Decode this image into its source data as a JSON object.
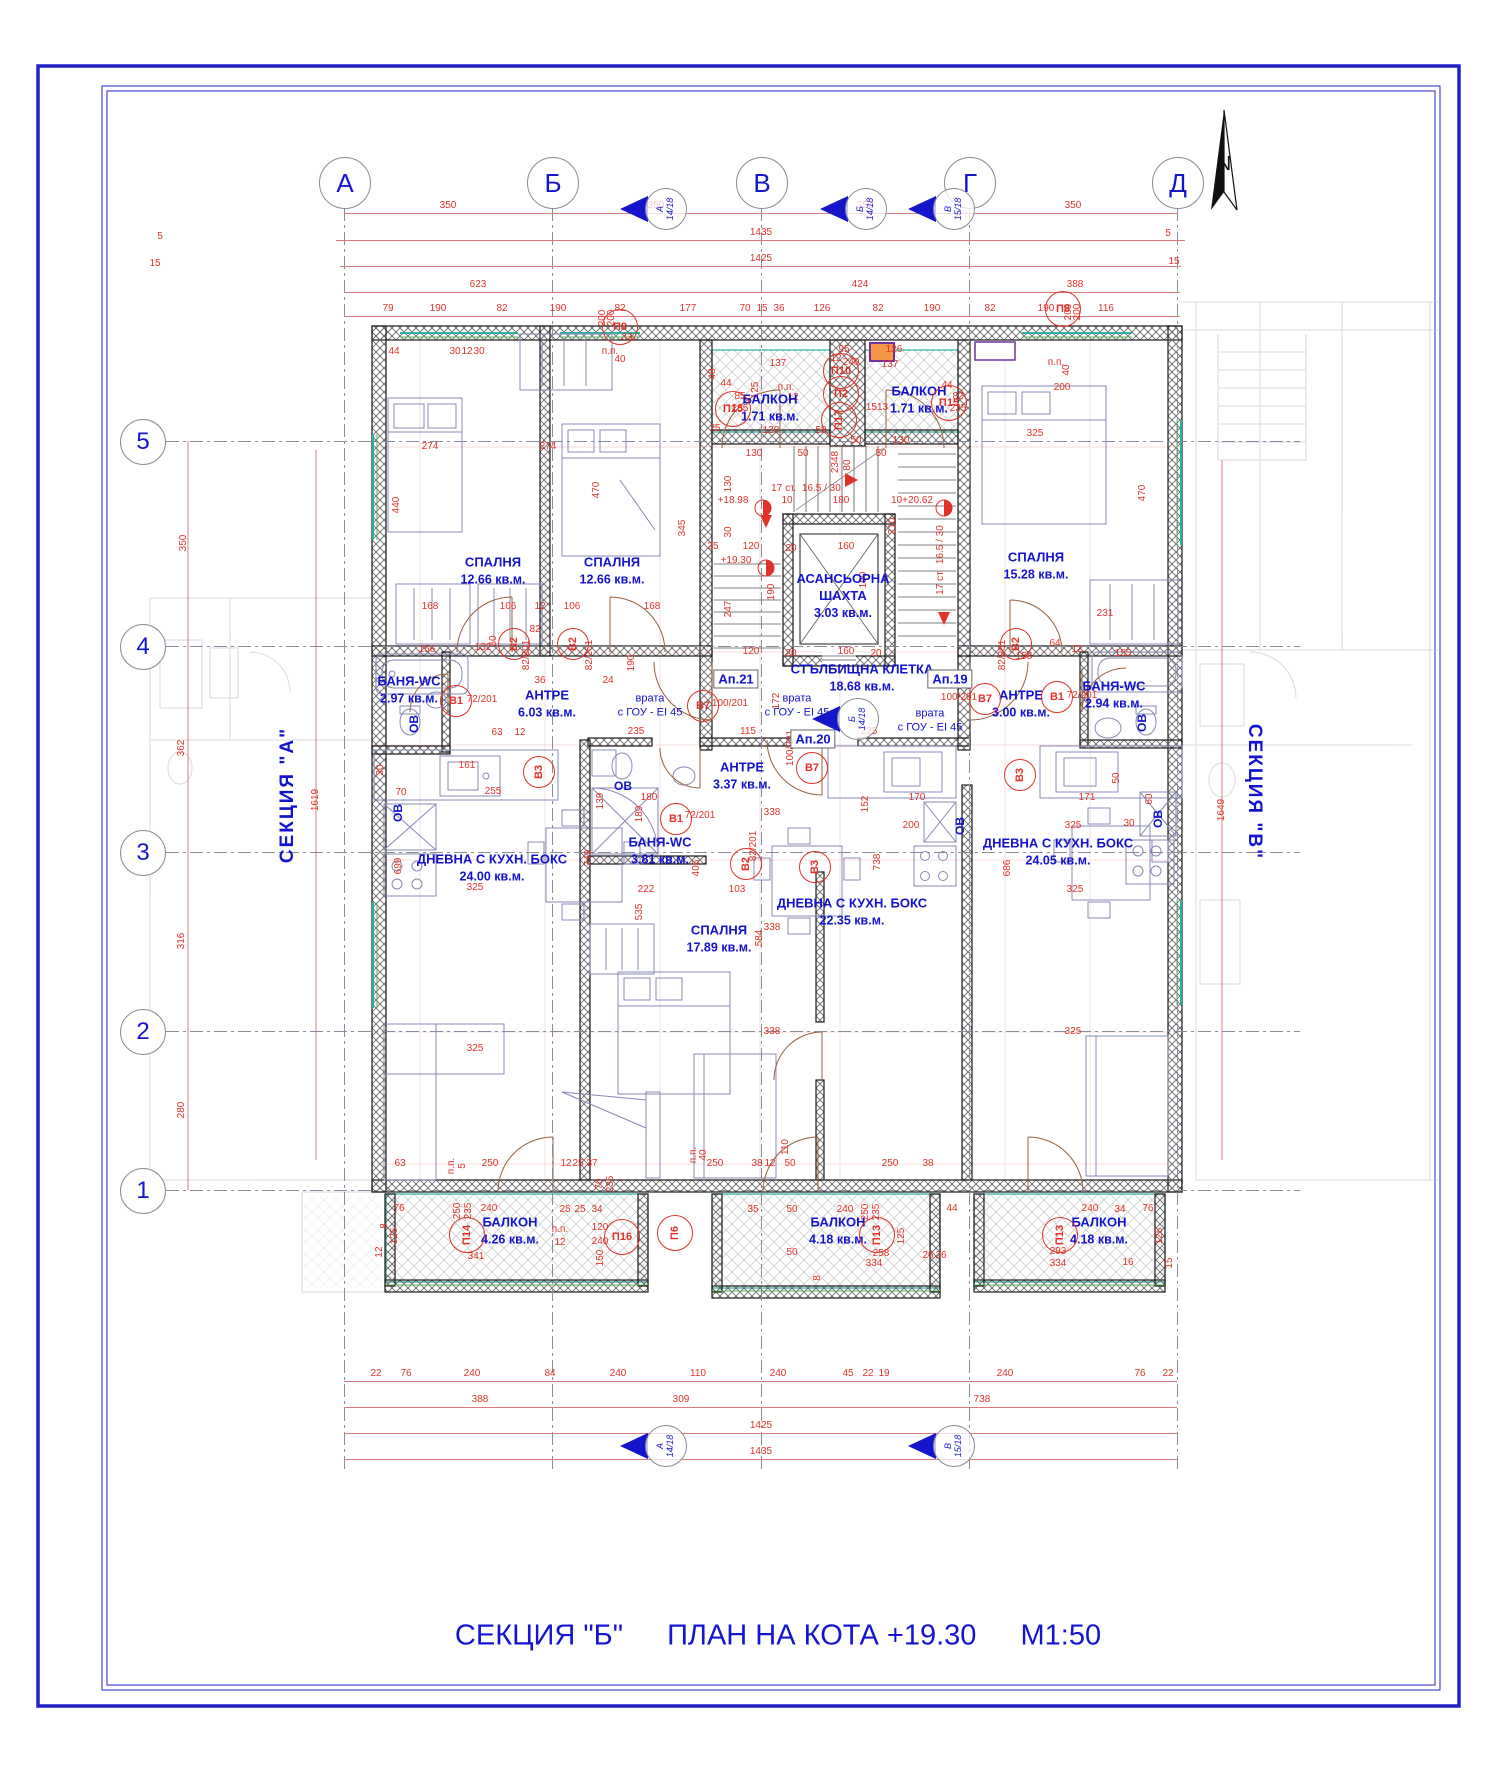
{
  "title": {
    "section": "СЕКЦИЯ \"Б\"",
    "plan": "ПЛАН НА КОТА +19.30",
    "scale": "М1:50"
  },
  "north": {
    "label": "N"
  },
  "side_sections": {
    "left": "СЕКЦИЯ  \"А\"",
    "right": "СЕКЦИЯ  \"В\""
  },
  "grid": {
    "cols": [
      {
        "label": "А",
        "x": 344
      },
      {
        "label": "Б",
        "x": 552
      },
      {
        "label": "В",
        "x": 761
      },
      {
        "label": "Г",
        "x": 969
      },
      {
        "label": "Д",
        "x": 1177
      }
    ],
    "rows": [
      {
        "label": "5",
        "y": 441
      },
      {
        "label": "4",
        "y": 646
      },
      {
        "label": "3",
        "y": 852
      },
      {
        "label": "2",
        "y": 1031
      },
      {
        "label": "1",
        "y": 1190
      }
    ]
  },
  "section_flags": [
    {
      "letter": "А",
      "ratio": "14/18",
      "x": 648,
      "y": 208
    },
    {
      "letter": "Б",
      "ratio": "14/18",
      "x": 848,
      "y": 208
    },
    {
      "letter": "В",
      "ratio": "15/18",
      "x": 936,
      "y": 208
    },
    {
      "letter": "Б",
      "ratio": "14/18",
      "x": 840,
      "y": 718
    },
    {
      "letter": "А",
      "ratio": "14/18",
      "x": 648,
      "y": 1445
    },
    {
      "letter": "В",
      "ratio": "15/18",
      "x": 936,
      "y": 1445
    }
  ],
  "rooms": [
    {
      "name": "СПАЛНЯ",
      "area": "12.66 кв.м.",
      "x": 493,
      "y": 571
    },
    {
      "name": "СПАЛНЯ",
      "area": "12.66 кв.м.",
      "x": 612,
      "y": 571
    },
    {
      "name": "СПАЛНЯ",
      "area": "15.28 кв.м.",
      "x": 1036,
      "y": 566
    },
    {
      "name": "СПАЛНЯ",
      "area": "17.89 кв.м.",
      "x": 719,
      "y": 939
    },
    {
      "name": "БАНЯ-WC",
      "area": "2.97 кв.м.",
      "x": 409,
      "y": 690
    },
    {
      "name": "БАНЯ-WC",
      "area": "2.94 кв.м.",
      "x": 1114,
      "y": 695
    },
    {
      "name": "БАНЯ-WC",
      "area": "3.81 кв.м.",
      "x": 660,
      "y": 851
    },
    {
      "name": "АНТРЕ",
      "area": "6.03 кв.м.",
      "x": 547,
      "y": 704
    },
    {
      "name": "АНТРЕ",
      "area": "3.00 кв.м.",
      "x": 1021,
      "y": 704
    },
    {
      "name": "АНТРЕ",
      "area": "3.37 кв.м.",
      "x": 742,
      "y": 776
    },
    {
      "name": "ДНЕВНА С КУХН. БОКС",
      "area": "24.00 кв.м.",
      "x": 492,
      "y": 868
    },
    {
      "name": "ДНЕВНА С КУХН. БОКС",
      "area": "22.35 кв.м.",
      "x": 852,
      "y": 912
    },
    {
      "name": "ДНЕВНА С КУХН. БОКС",
      "area": "24.05 кв.м.",
      "x": 1058,
      "y": 852
    },
    {
      "name": "БАЛКОН",
      "area": "1.71 кв.м.",
      "x": 770,
      "y": 408
    },
    {
      "name": "БАЛКОН",
      "area": "1.71 кв.м.",
      "x": 919,
      "y": 400
    },
    {
      "name": "БАЛКОН",
      "area": "4.26 кв.м.",
      "x": 510,
      "y": 1231
    },
    {
      "name": "БАЛКОН",
      "area": "4.18 кв.м.",
      "x": 838,
      "y": 1231
    },
    {
      "name": "БАЛКОН",
      "area": "4.18 кв.м.",
      "x": 1099,
      "y": 1231
    },
    {
      "name": "АСАНСЬОРНА ШАХТА",
      "area": "3.03 кв.м.",
      "x": 843,
      "y": 596,
      "w": 120
    },
    {
      "name": "СТЪЛБИЩНА КЛЕТКА",
      "area": "18.68 кв.м.",
      "x": 862,
      "y": 678
    }
  ],
  "apartments": [
    {
      "label": "Ап.21",
      "x": 736,
      "y": 679
    },
    {
      "label": "Ап.20",
      "x": 813,
      "y": 739
    },
    {
      "label": "Ап.19",
      "x": 950,
      "y": 679
    }
  ],
  "door_note": {
    "line1": "врата",
    "line2": "с ГОУ - EI 45",
    "positions": [
      {
        "x": 650,
        "y": 706
      },
      {
        "x": 797,
        "y": 706
      },
      {
        "x": 930,
        "y": 721
      }
    ]
  },
  "ov_label": {
    "text": "ОВ",
    "positions": [
      {
        "x": 414,
        "y": 724,
        "r": 1
      },
      {
        "x": 398,
        "y": 813,
        "r": 1
      },
      {
        "x": 623,
        "y": 786
      },
      {
        "x": 960,
        "y": 826,
        "r": 1
      },
      {
        "x": 1142,
        "y": 723,
        "r": 1
      },
      {
        "x": 1158,
        "y": 819,
        "r": 1
      }
    ]
  },
  "valve_circles": [
    {
      "t": "В1",
      "x": 456,
      "y": 701
    },
    {
      "t": "В2",
      "x": 514,
      "y": 644,
      "r": 1
    },
    {
      "t": "В2",
      "x": 573,
      "y": 644,
      "r": 1
    },
    {
      "t": "В3",
      "x": 539,
      "y": 772,
      "r": 1
    },
    {
      "t": "В7",
      "x": 703,
      "y": 706
    },
    {
      "t": "В7",
      "x": 812,
      "y": 768
    },
    {
      "t": "В1",
      "x": 676,
      "y": 819
    },
    {
      "t": "В2",
      "x": 746,
      "y": 864,
      "r": 1
    },
    {
      "t": "В3",
      "x": 815,
      "y": 867,
      "r": 1
    },
    {
      "t": "В7",
      "x": 985,
      "y": 699
    },
    {
      "t": "В1",
      "x": 1057,
      "y": 697
    },
    {
      "t": "В2",
      "x": 1016,
      "y": 644,
      "r": 1
    },
    {
      "t": "В3",
      "x": 1020,
      "y": 775,
      "r": 1
    }
  ],
  "panel_circles": [
    {
      "t": "П8",
      "x": 620,
      "y": 327
    },
    {
      "t": "П8",
      "x": 1063,
      "y": 309
    },
    {
      "t": "П10",
      "x": 841,
      "y": 371
    },
    {
      "t": "П2",
      "x": 841,
      "y": 394
    },
    {
      "t": "П17",
      "x": 839,
      "y": 420,
      "r": 1
    },
    {
      "t": "П15",
      "x": 733,
      "y": 409
    },
    {
      "t": "П15",
      "x": 949,
      "y": 403
    },
    {
      "t": "П14",
      "x": 467,
      "y": 1235,
      "r": 1
    },
    {
      "t": "П16",
      "x": 622,
      "y": 1237
    },
    {
      "t": "П6",
      "x": 675,
      "y": 1233,
      "r": 1
    },
    {
      "t": "П13",
      "x": 877,
      "y": 1235,
      "r": 1
    },
    {
      "t": "П13",
      "x": 1060,
      "y": 1235,
      "r": 1
    }
  ],
  "dim_rows": {
    "top": [
      {
        "y": 213,
        "x1": 344,
        "x2": 1177,
        "labels": [
          [
            "350",
            448
          ],
          [
            "350",
            656
          ],
          [
            "350",
            865
          ],
          [
            "350",
            1073
          ]
        ]
      },
      {
        "y": 240,
        "x1": 336,
        "x2": 1185,
        "labels": [
          [
            "1435",
            761
          ]
        ]
      },
      {
        "y": 266,
        "x1": 340,
        "x2": 1181,
        "labels": [
          [
            "1425",
            761
          ]
        ]
      },
      {
        "y": 292,
        "x1": 344,
        "x2": 1180,
        "labels": [
          [
            "623",
            478
          ],
          [
            "424",
            860
          ],
          [
            "388",
            1075
          ]
        ]
      },
      {
        "y": 316,
        "x1": 344,
        "x2": 1180,
        "labels": [
          [
            "79",
            388
          ],
          [
            "190",
            438
          ],
          [
            "82",
            502
          ],
          [
            "190",
            558
          ],
          [
            "82",
            620
          ],
          [
            "177",
            688
          ],
          [
            "70",
            745
          ],
          [
            "15",
            762
          ],
          [
            "36",
            779
          ],
          [
            "126",
            822
          ],
          [
            "82",
            878
          ],
          [
            "190",
            932
          ],
          [
            "82",
            990
          ],
          [
            "190",
            1046
          ],
          [
            "116",
            1106
          ]
        ]
      }
    ],
    "bottom": [
      {
        "y": 1381,
        "x1": 344,
        "x2": 1177,
        "labels": [
          [
            "22",
            376
          ],
          [
            "76",
            406
          ],
          [
            "240",
            472
          ],
          [
            "84",
            550
          ],
          [
            "240",
            618
          ],
          [
            "110",
            698
          ],
          [
            "240",
            778
          ],
          [
            "45",
            848
          ],
          [
            "22",
            868
          ],
          [
            "19",
            884
          ],
          [
            "240",
            1005
          ],
          [
            "76",
            1140
          ],
          [
            "22",
            1168
          ]
        ]
      },
      {
        "y": 1407,
        "x1": 344,
        "x2": 1177,
        "labels": [
          [
            "388",
            480
          ],
          [
            "309",
            681
          ],
          [
            "738",
            982
          ]
        ]
      },
      {
        "y": 1433,
        "x1": 344,
        "x2": 1177,
        "labels": [
          [
            "1425",
            761
          ]
        ]
      },
      {
        "y": 1459,
        "x1": 344,
        "x2": 1177,
        "labels": [
          [
            "1435",
            761
          ]
        ]
      }
    ]
  },
  "dims": [
    [
      "274",
      430,
      447
    ],
    [
      "274",
      548,
      447
    ],
    [
      "440",
      397,
      505,
      1
    ],
    [
      "470",
      597,
      490,
      1
    ],
    [
      "345",
      683,
      528,
      1
    ],
    [
      "470",
      1143,
      493,
      1
    ],
    [
      "325",
      1035,
      434
    ],
    [
      "44",
      394,
      352
    ],
    [
      "30",
      455,
      352
    ],
    [
      "12",
      467,
      352
    ],
    [
      "30",
      479,
      352
    ],
    [
      "200",
      603,
      318,
      1
    ],
    [
      "200",
      612,
      318,
      1
    ],
    [
      "33",
      627,
      338
    ],
    [
      "п.п.",
      610,
      352
    ],
    [
      "40",
      620,
      360
    ],
    [
      "200",
      1069,
      312,
      1
    ],
    [
      "200",
      1078,
      312,
      1
    ],
    [
      "п.п.",
      1056,
      363
    ],
    [
      "40",
      1067,
      370,
      1
    ],
    [
      "200",
      1062,
      388
    ],
    [
      "137",
      778,
      364
    ],
    [
      "48",
      713,
      374,
      1
    ],
    [
      "85",
      740,
      397
    ],
    [
      "235",
      740,
      409
    ],
    [
      "44",
      726,
      384
    ],
    [
      "125",
      756,
      390,
      1
    ],
    [
      "130",
      771,
      431
    ],
    [
      "50",
      821,
      431
    ],
    [
      "25",
      715,
      429
    ],
    [
      "95",
      844,
      350
    ],
    [
      "12",
      836,
      359
    ],
    [
      "240",
      851,
      363
    ],
    [
      "126",
      894,
      350
    ],
    [
      "137",
      890,
      365
    ],
    [
      "1513",
      877,
      408
    ],
    [
      "44",
      947,
      386
    ],
    [
      "82",
      958,
      397
    ],
    [
      "235",
      958,
      409
    ],
    [
      "50",
      856,
      441
    ],
    [
      "130",
      901,
      441
    ],
    [
      "п.п.",
      786,
      388
    ],
    [
      "12",
      793,
      398
    ],
    [
      "2348",
      836,
      462,
      1
    ],
    [
      "80",
      848,
      465,
      1
    ],
    [
      "130",
      754,
      454
    ],
    [
      "50",
      803,
      454
    ],
    [
      "50",
      881,
      454
    ],
    [
      "17 ст.  16.5 / 30",
      806,
      489
    ],
    [
      "10",
      787,
      501
    ],
    [
      "180",
      841,
      501
    ],
    [
      "+18.98",
      733,
      501
    ],
    [
      "10+20.62",
      912,
      501
    ],
    [
      "130",
      729,
      484,
      1
    ],
    [
      "30",
      729,
      532,
      1
    ],
    [
      "120",
      751,
      547
    ],
    [
      "25",
      713,
      547
    ],
    [
      "20",
      791,
      549
    ],
    [
      "160",
      846,
      547
    ],
    [
      "+19.30",
      736,
      561
    ],
    [
      "190",
      772,
      592,
      1
    ],
    [
      "190",
      864,
      580,
      1
    ],
    [
      "210",
      893,
      526,
      1
    ],
    [
      "247",
      729,
      609,
      1
    ],
    [
      "17 ст.  16.5 / 30",
      941,
      560,
      1
    ],
    [
      "120",
      751,
      652
    ],
    [
      "20",
      791,
      654
    ],
    [
      "160",
      846,
      652
    ],
    [
      "20",
      876,
      654
    ],
    [
      "168",
      430,
      607
    ],
    [
      "106",
      508,
      607
    ],
    [
      "12",
      540,
      607
    ],
    [
      "106",
      572,
      607
    ],
    [
      "168",
      652,
      607
    ],
    [
      "156",
      427,
      650
    ],
    [
      "132",
      483,
      648
    ],
    [
      "36",
      540,
      681
    ],
    [
      "24",
      608,
      681
    ],
    [
      "190",
      632,
      663,
      1
    ],
    [
      "231",
      1105,
      614
    ],
    [
      "64",
      1055,
      644
    ],
    [
      "155",
      1123,
      654
    ],
    [
      "158",
      1024,
      657
    ],
    [
      "12",
      1077,
      650
    ],
    [
      "235",
      636,
      732
    ],
    [
      "115",
      748,
      732
    ],
    [
      "172",
      777,
      701,
      1
    ],
    [
      "225",
      869,
      732
    ],
    [
      "72/201",
      482,
      700
    ],
    [
      "82/201",
      527,
      655,
      1
    ],
    [
      "82/201",
      590,
      655,
      1
    ],
    [
      "100/201",
      730,
      704
    ],
    [
      "100/201",
      959,
      698
    ],
    [
      "72/201",
      1082,
      696
    ],
    [
      "82/201",
      1003,
      655,
      1
    ],
    [
      "100/201",
      791,
      748,
      1
    ],
    [
      "72/201",
      700,
      816
    ],
    [
      "82/201",
      754,
      846,
      1
    ],
    [
      "82",
      535,
      630
    ],
    [
      "60",
      494,
      641,
      1
    ],
    [
      "63",
      497,
      733
    ],
    [
      "12",
      520,
      733
    ],
    [
      "161",
      467,
      766
    ],
    [
      "255",
      493,
      792
    ],
    [
      "70",
      401,
      793
    ],
    [
      "30",
      381,
      770,
      1
    ],
    [
      "325",
      475,
      888
    ],
    [
      "139",
      601,
      801,
      1
    ],
    [
      "180",
      649,
      798
    ],
    [
      "189",
      640,
      814,
      1
    ],
    [
      "222",
      646,
      890
    ],
    [
      "103",
      737,
      890
    ],
    [
      "170",
      917,
      798
    ],
    [
      "171",
      1087,
      798
    ],
    [
      "200",
      911,
      826
    ],
    [
      "325",
      1073,
      826
    ],
    [
      "325",
      1075,
      890
    ],
    [
      "152",
      866,
      804,
      1
    ],
    [
      "50",
      1117,
      778,
      1
    ],
    [
      "60",
      1150,
      799,
      1
    ],
    [
      "30",
      1129,
      824
    ],
    [
      "338",
      772,
      813
    ],
    [
      "338",
      772,
      928
    ],
    [
      "584",
      760,
      938,
      1
    ],
    [
      "406",
      697,
      868,
      1
    ],
    [
      "749",
      589,
      858,
      1
    ],
    [
      "738",
      878,
      862,
      1
    ],
    [
      "686",
      1008,
      868,
      1
    ],
    [
      "699",
      399,
      866,
      1
    ],
    [
      "535",
      640,
      912,
      1
    ],
    [
      "325",
      475,
      1049
    ],
    [
      "338",
      772,
      1032
    ],
    [
      "325",
      1073,
      1032
    ],
    [
      "63",
      400,
      1164
    ],
    [
      "250",
      490,
      1164
    ],
    [
      "п.п.",
      452,
      1166,
      1
    ],
    [
      "5",
      463,
      1166,
      1
    ],
    [
      "37",
      592,
      1164
    ],
    [
      "12",
      566,
      1164
    ],
    [
      "25",
      578,
      1164
    ],
    [
      "70",
      600,
      1184,
      1
    ],
    [
      "235",
      611,
      1184,
      1
    ],
    [
      "250",
      715,
      1164
    ],
    [
      "38",
      757,
      1164
    ],
    [
      "12",
      770,
      1164
    ],
    [
      "50",
      790,
      1164
    ],
    [
      "110",
      786,
      1147,
      1
    ],
    [
      "п.п.",
      694,
      1155,
      1
    ],
    [
      "40",
      704,
      1155,
      1
    ],
    [
      "250",
      890,
      1164
    ],
    [
      "38",
      928,
      1164
    ],
    [
      "76",
      399,
      1209
    ],
    [
      "8",
      385,
      1226,
      1
    ],
    [
      "250",
      458,
      1211,
      1
    ],
    [
      "235",
      469,
      1211,
      1
    ],
    [
      "240",
      489,
      1209
    ],
    [
      "25",
      565,
      1210
    ],
    [
      "25",
      580,
      1210
    ],
    [
      "34",
      597,
      1210
    ],
    [
      "120",
      600,
      1228
    ],
    [
      "240",
      600,
      1242
    ],
    [
      "п.п.",
      560,
      1230
    ],
    [
      "12",
      560,
      1243
    ],
    [
      "341",
      476,
      1257
    ],
    [
      "125",
      395,
      1236,
      1
    ],
    [
      "150",
      601,
      1258,
      1
    ],
    [
      "12",
      380,
      1252,
      1
    ],
    [
      "35",
      753,
      1210
    ],
    [
      "50",
      792,
      1210
    ],
    [
      "240",
      845,
      1210
    ],
    [
      "250",
      866,
      1212,
      1
    ],
    [
      "235",
      877,
      1212,
      1
    ],
    [
      "44",
      952,
      1209
    ],
    [
      "125",
      902,
      1236,
      1
    ],
    [
      "258",
      881,
      1254
    ],
    [
      "334",
      874,
      1264
    ],
    [
      "50",
      792,
      1253
    ],
    [
      "26",
      928,
      1256
    ],
    [
      "26",
      941,
      1256
    ],
    [
      "8",
      818,
      1278,
      1
    ],
    [
      "240",
      1090,
      1209
    ],
    [
      "76",
      1148,
      1209
    ],
    [
      "34",
      1120,
      1210
    ],
    [
      "293",
      1058,
      1252
    ],
    [
      "334",
      1058,
      1264
    ],
    [
      "125",
      1160,
      1236,
      1
    ],
    [
      "16",
      1128,
      1263
    ],
    [
      "15",
      1170,
      1263,
      1
    ],
    [
      "350",
      184,
      543,
      1
    ],
    [
      "362",
      182,
      748,
      1
    ],
    [
      "316",
      182,
      941,
      1
    ],
    [
      "280",
      182,
      1110,
      1
    ],
    [
      "1619",
      316,
      800,
      1
    ],
    [
      "1649",
      1222,
      810,
      1
    ],
    [
      "5",
      160,
      237
    ],
    [
      "15",
      155,
      264
    ],
    [
      "5",
      1168,
      234
    ],
    [
      "15",
      1174,
      262
    ]
  ],
  "colors": {
    "accent_blue": "#1515cc",
    "dim_red": "#e03229",
    "wall": "#1c1c1c",
    "window_teal": "#28b0a0",
    "window_green": "#58b058",
    "fixture_orange": "#f79646",
    "fixture_purple": "#7030a0"
  }
}
